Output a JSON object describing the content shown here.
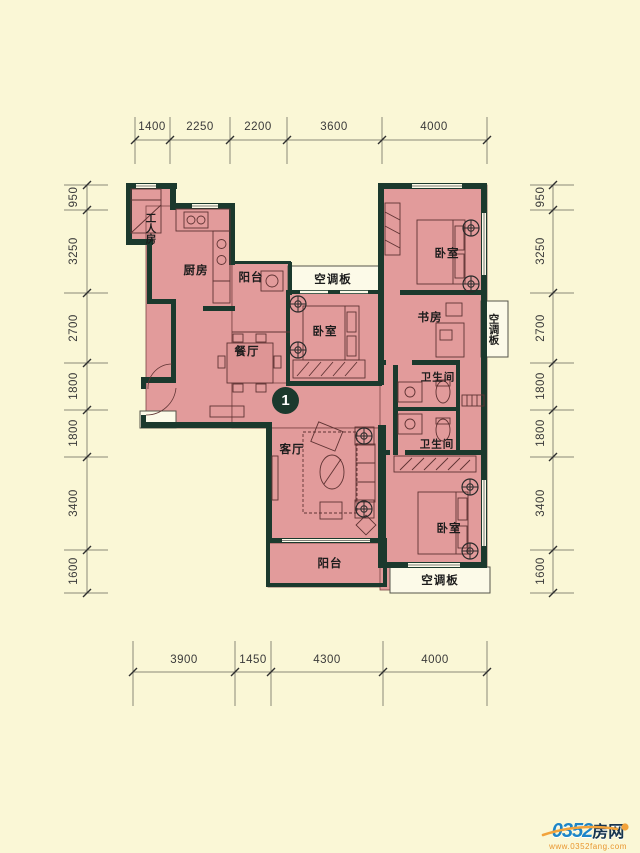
{
  "plan": {
    "unit_number": "1",
    "rooms": {
      "worker_room": "工人房",
      "kitchen": "厨房",
      "balcony_top": "阳台",
      "ac_panel_top": "空调板",
      "bedroom_top_right": "卧室",
      "bedroom_middle": "卧室",
      "study": "书房",
      "ac_panel_right": "空调板",
      "bathroom_upper": "卫生间",
      "bathroom_lower": "卫生间",
      "dining_room": "餐厅",
      "living_room": "客厅",
      "bedroom_bottom_right": "卧室",
      "balcony_bottom": "阳台",
      "ac_panel_bottom": "空调板"
    },
    "colors": {
      "background": "#FAF7D6",
      "wall": "#1B392D",
      "room_fill": "#E29B9B",
      "panel_fill": "#FCFAE8",
      "logo_blue": "#1C85C8",
      "logo_orange": "#F2A33C"
    }
  },
  "dimensions": {
    "top": [
      "1400",
      "2250",
      "2200",
      "3600",
      "4000"
    ],
    "bottom": [
      "3900",
      "1450",
      "4300",
      "4000"
    ],
    "left": [
      "950",
      "3250",
      "2700",
      "1800",
      "1800",
      "3400",
      "1600"
    ],
    "right": [
      "950",
      "3250",
      "2700",
      "1800",
      "1800",
      "3400",
      "1600"
    ]
  },
  "watermark": {
    "site_number": "0352",
    "site_word": "房网",
    "url": "www.0352fang.com"
  }
}
